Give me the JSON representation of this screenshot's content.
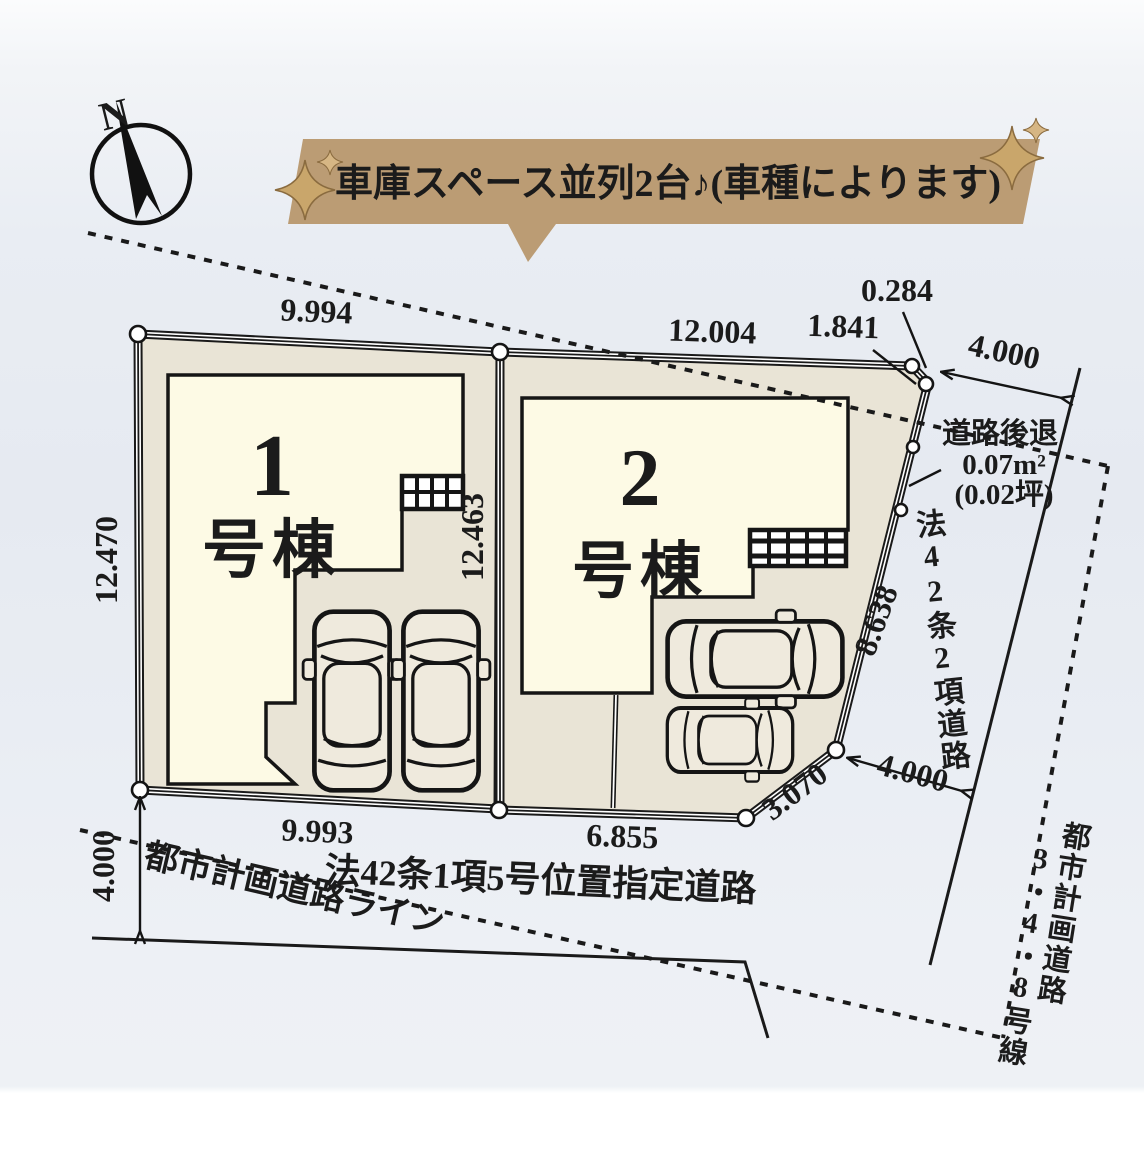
{
  "banner": {
    "text": "車庫スペース並列2台♪(車種によります)"
  },
  "compass": {
    "north": "N"
  },
  "lots": {
    "lot1": {
      "number": "1",
      "label": "号棟",
      "dim_top": "9.994",
      "dim_left": "12.470",
      "dim_right": "12.463",
      "dim_bottom": "9.993"
    },
    "lot2": {
      "number": "2",
      "label": "号棟",
      "dim_top": "12.004",
      "dim_top_right": "1.841",
      "dim_corner": "0.284",
      "dim_right": "8.638",
      "dim_bottom": "6.855",
      "dim_chamfer": "3.070"
    }
  },
  "roads": {
    "right_width_top": "4.000",
    "right_width_bottom": "4.000",
    "right_name": "法42条2項道路",
    "bottom_name": "法42条1項5号位置指定道路",
    "bottom_width": "4.000",
    "planning_line": "都市計画道路ライン",
    "planning_name": "都市計画道路",
    "planning_route": "3・4・8号線"
  },
  "setback": {
    "title": "道路後退",
    "area": "0.07m²",
    "tsubo": "(0.02坪)"
  }
}
